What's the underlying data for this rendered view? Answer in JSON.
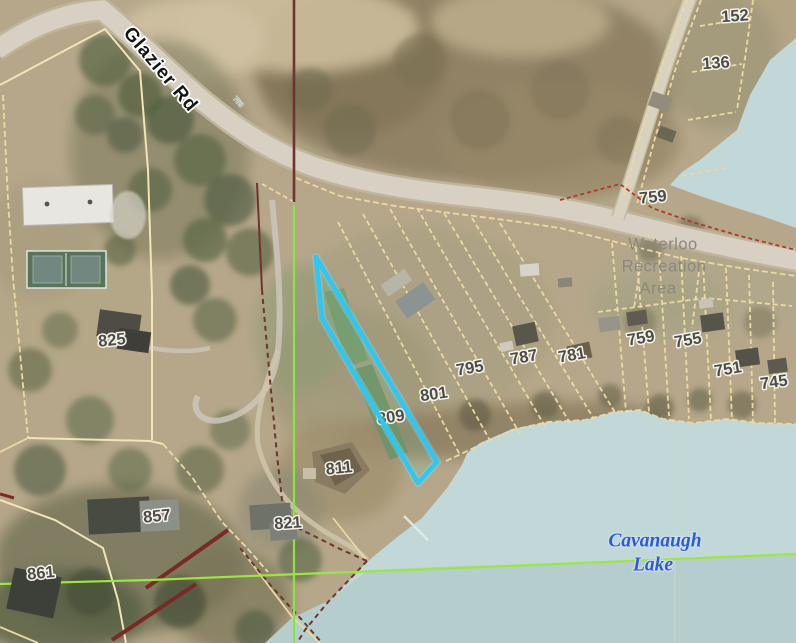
{
  "map": {
    "road": {
      "name": "Glazier Rd",
      "small_marker": "753"
    },
    "area_label": {
      "line1": "Waterloo",
      "line2": "Recreation",
      "line3": "Area"
    },
    "lake_label": {
      "line1": "Cavanaugh",
      "line2": "Lake"
    },
    "parcel_labels": [
      {
        "label": "152"
      },
      {
        "label": "136"
      },
      {
        "label": "759"
      },
      {
        "label": "795"
      },
      {
        "label": "787"
      },
      {
        "label": "781"
      },
      {
        "label": "759"
      },
      {
        "label": "755"
      },
      {
        "label": "751"
      },
      {
        "label": "745"
      },
      {
        "label": "801"
      },
      {
        "label": "809"
      },
      {
        "label": "811"
      },
      {
        "label": "825"
      },
      {
        "label": "821"
      },
      {
        "label": "857"
      },
      {
        "label": "861"
      }
    ],
    "colors": {
      "selected_parcel_outline": "#2cc7f2",
      "water": "#c1d7d8",
      "parcel_line": "#ead9a4",
      "section_line_green": "#8ae63e",
      "boundary_maroon": "#6d3430",
      "road_fill": "#d7d0c3",
      "parcel_number_text": "#4c4c48",
      "lake_label_blue": "#2b5cd8",
      "area_label_gray": "#8b897b",
      "red_dashed_line": "#b5362c"
    }
  }
}
